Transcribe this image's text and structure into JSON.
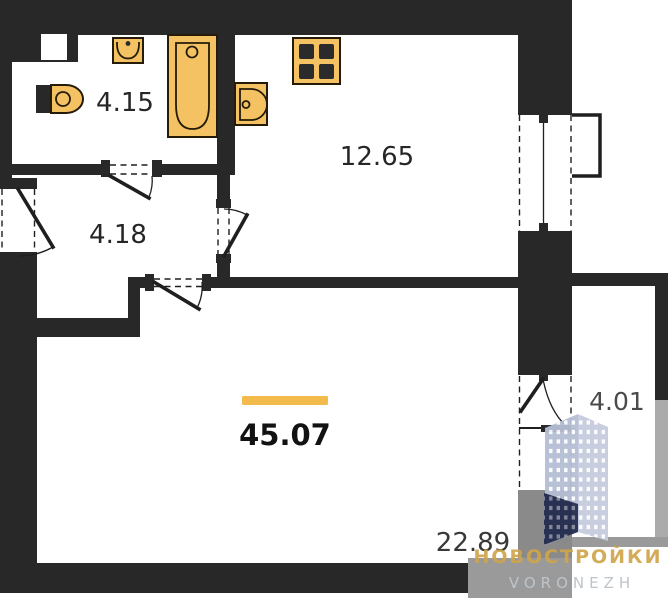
{
  "plan": {
    "rooms": {
      "bathroom": {
        "area": "4.15"
      },
      "kitchen": {
        "area": "12.65"
      },
      "hallway": {
        "area": "4.18"
      },
      "living_room": {
        "area": "22.89"
      },
      "balcony": {
        "area": "4.01"
      }
    },
    "total_area": "45.07",
    "fixtures": [
      "toilet-icon",
      "bath-sink-icon",
      "bathtub-icon",
      "kitchen-sink-icon",
      "stove-icon"
    ],
    "colors": {
      "wall": "#282828",
      "fixture_fill": "#f5c263",
      "fixture_outline": "#241c08",
      "accent_bar": "#f2bb4c",
      "balcony_gray": "#9a9a9a",
      "shadow_gray": "#8a8a8a"
    }
  },
  "watermark": {
    "brand": "НОВОСТРОЙКИ",
    "city": "VORONEZH",
    "brand_color": "#cfa54b",
    "city_color": "#bdc5cb",
    "building_light": "#b6bed5",
    "building_dark": "#232d4f"
  }
}
